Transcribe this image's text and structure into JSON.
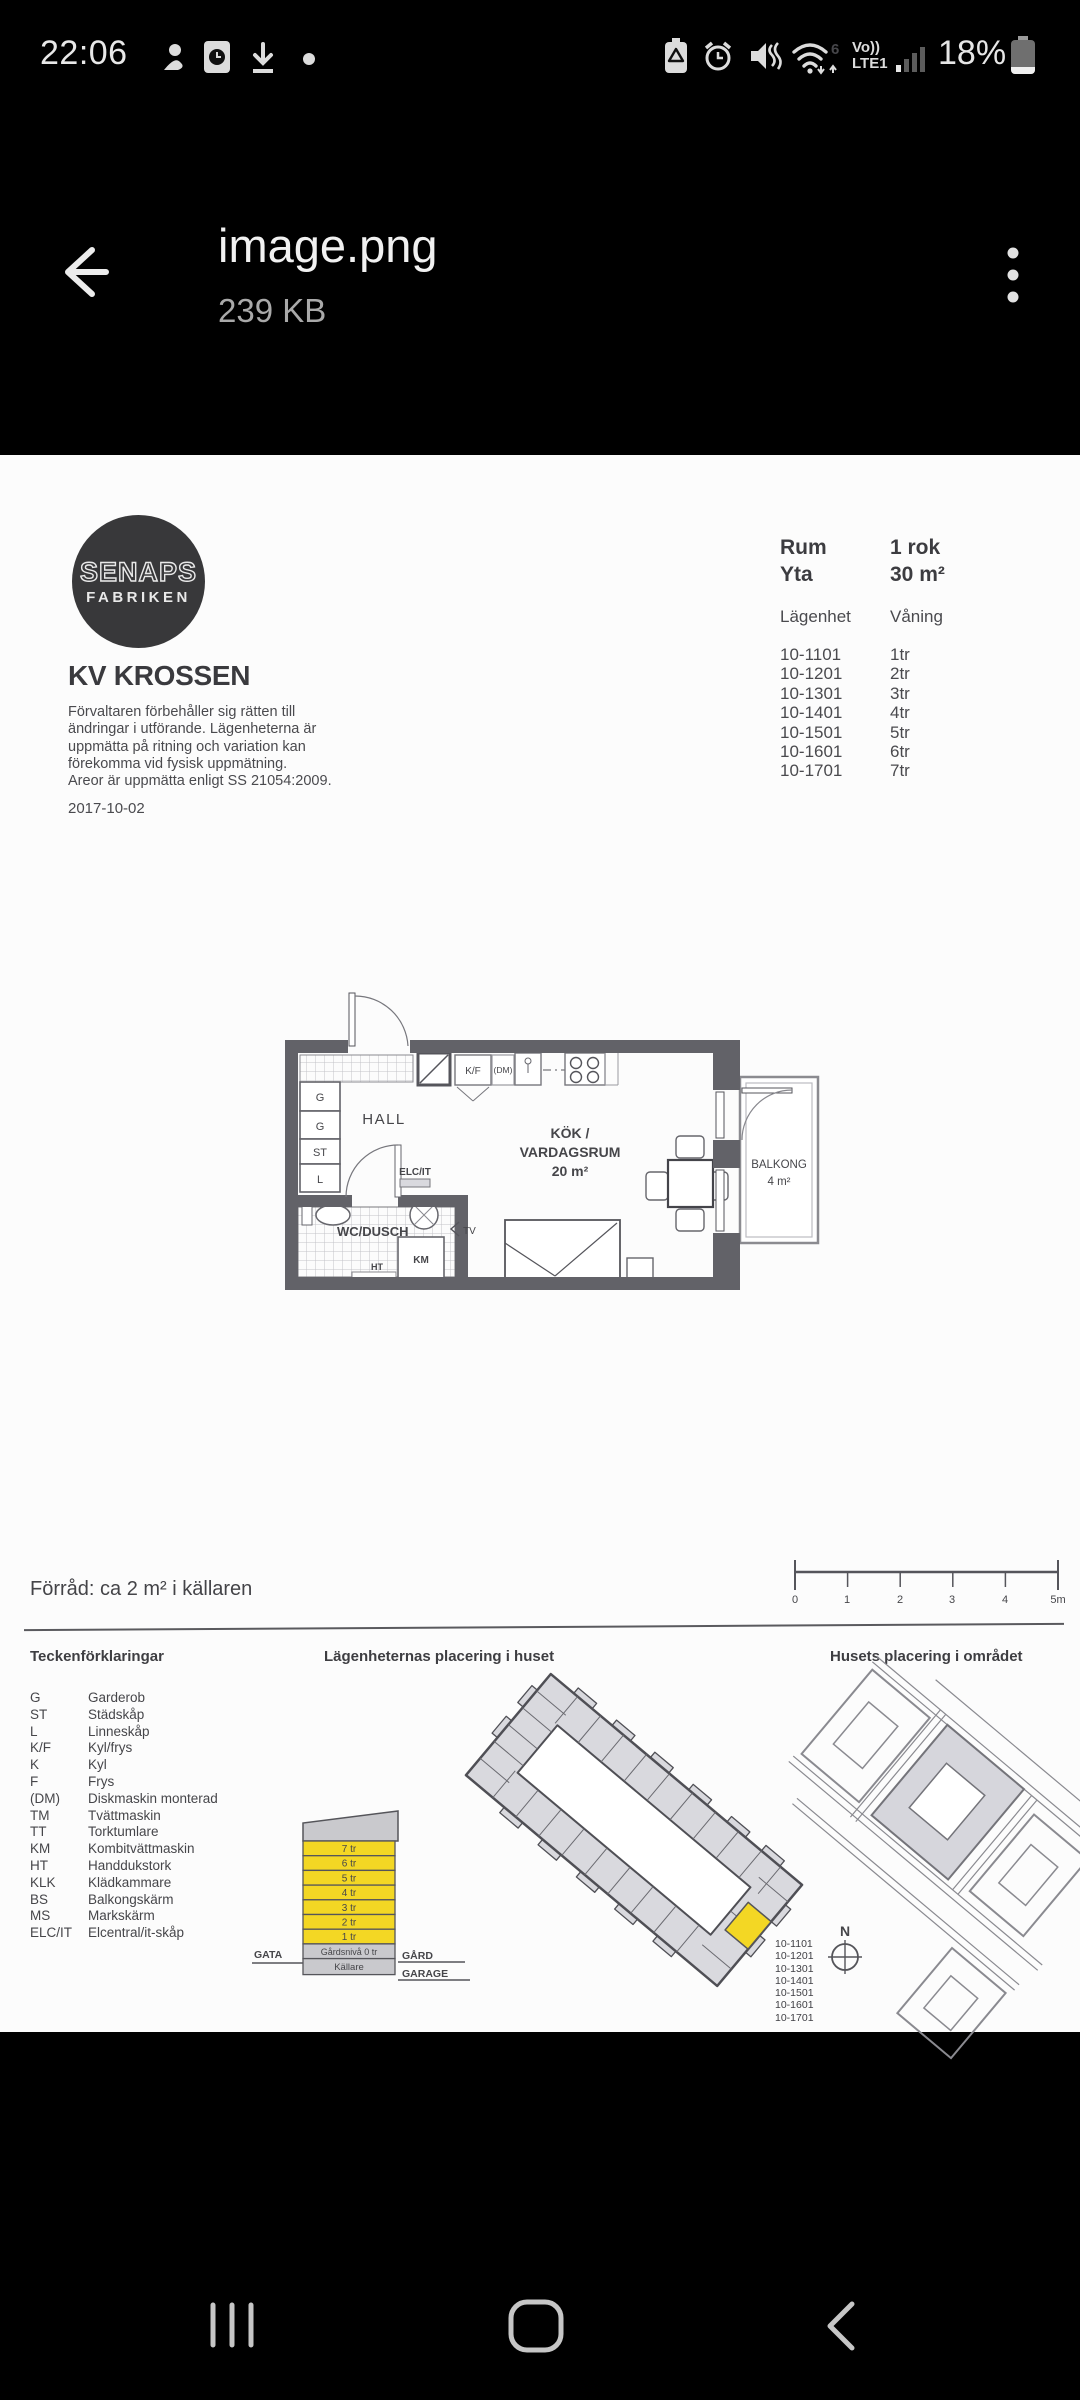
{
  "status_bar": {
    "time": "22:06",
    "wifi_standard": "6",
    "volte_line1": "Vo))",
    "volte_line2": "LTE1",
    "battery_percent": "18%"
  },
  "header": {
    "title": "image.png",
    "size": "239 KB"
  },
  "document": {
    "logo": {
      "top": "SENAPS",
      "bottom": "FABRIKEN"
    },
    "project_title": "KV KROSSEN",
    "disclaimer": [
      "Förvaltaren förbehåller sig rätten till",
      "ändringar i utförande. Lägenheterna är",
      "uppmätta på ritning och variation kan",
      "förekomma vid fysisk uppmätning.",
      "Areor är uppmätta enligt SS 21054:2009."
    ],
    "date": "2017-10-02",
    "table": {
      "rum_label": "Rum",
      "rum_value": "1 rok",
      "yta_label": "Yta",
      "yta_value": "30 m²",
      "apt_label": "Lägenhet",
      "floor_label": "Våning",
      "rows": [
        {
          "apt": "10-1101",
          "floor": "1tr"
        },
        {
          "apt": "10-1201",
          "floor": "2tr"
        },
        {
          "apt": "10-1301",
          "floor": "3tr"
        },
        {
          "apt": "10-1401",
          "floor": "4tr"
        },
        {
          "apt": "10-1501",
          "floor": "5tr"
        },
        {
          "apt": "10-1601",
          "floor": "6tr"
        },
        {
          "apt": "10-1701",
          "floor": "7tr"
        }
      ]
    },
    "floor_plan": {
      "hall": "HALL",
      "g1": "G",
      "g2": "G",
      "st": "ST",
      "l": "L",
      "kf": "K/F",
      "dm": "(DM)",
      "wc": "WC/DUSCH",
      "elcit": "ELC/IT",
      "km": "KM",
      "ht": "HT",
      "tv": "TV",
      "kok1": "KÖK /",
      "kok2": "VARDAGSRUM",
      "kok_area": "20 m²",
      "balkong": "BALKONG",
      "balkong_area": "4 m²"
    },
    "storage_note": "Förråd: ca 2 m² i källaren",
    "scale": {
      "ticks": [
        "0",
        "1",
        "2",
        "3",
        "4",
        "5m"
      ]
    },
    "legend": {
      "title": "Teckenförklaringar",
      "items": [
        {
          "abbr": "G",
          "term": "Garderob"
        },
        {
          "abbr": "ST",
          "term": "Städskåp"
        },
        {
          "abbr": "L",
          "term": "Linneskåp"
        },
        {
          "abbr": "K/F",
          "term": "Kyl/frys"
        },
        {
          "abbr": "K",
          "term": "Kyl"
        },
        {
          "abbr": "F",
          "term": "Frys"
        },
        {
          "abbr": "(DM)",
          "term": "Diskmaskin monterad"
        },
        {
          "abbr": "TM",
          "term": "Tvättmaskin"
        },
        {
          "abbr": "TT",
          "term": "Torktumlare"
        },
        {
          "abbr": "KM",
          "term": "Kombitvättmaskin"
        },
        {
          "abbr": "HT",
          "term": "Handdukstork"
        },
        {
          "abbr": "KLK",
          "term": "Klädkammare"
        },
        {
          "abbr": "BS",
          "term": "Balkongskärm"
        },
        {
          "abbr": "MS",
          "term": "Markskärm"
        },
        {
          "abbr": "ELC/IT",
          "term": "Elcentral/it-skåp"
        }
      ]
    },
    "placement": {
      "title": "Lägenheternas placering i huset",
      "compass": "N",
      "apartments": [
        "10-1101",
        "10-1201",
        "10-1301",
        "10-1401",
        "10-1501",
        "10-1601",
        "10-1701"
      ]
    },
    "section": {
      "floors": [
        "7 tr",
        "6 tr",
        "5 tr",
        "4 tr",
        "3 tr",
        "2 tr",
        "1 tr"
      ],
      "ground": "Gårdsnivå 0 tr",
      "basement": "Källare",
      "street": "GATA",
      "yard": "GÅRD",
      "garage": "GARAGE"
    },
    "site": {
      "title": "Husets placering i området"
    }
  },
  "colors": {
    "highlight_yellow": "#f3d724",
    "building_gray": "#d9d9de",
    "wall_gray": "#626268",
    "page_white": "#fcfcfc"
  },
  "icons": {
    "status_left": [
      "profile-icon",
      "clock-app-icon",
      "download-icon",
      "notification-dot-icon"
    ],
    "status_right": [
      "battery-saver-icon",
      "alarm-icon",
      "mute-icon",
      "wifi-6-icon",
      "mobile-signal-icon",
      "battery-icon"
    ],
    "header": [
      "back-arrow-icon",
      "kebab-menu-icon"
    ],
    "nav": [
      "recents-icon",
      "home-icon",
      "back-icon"
    ],
    "map": [
      "compass-icon"
    ]
  }
}
